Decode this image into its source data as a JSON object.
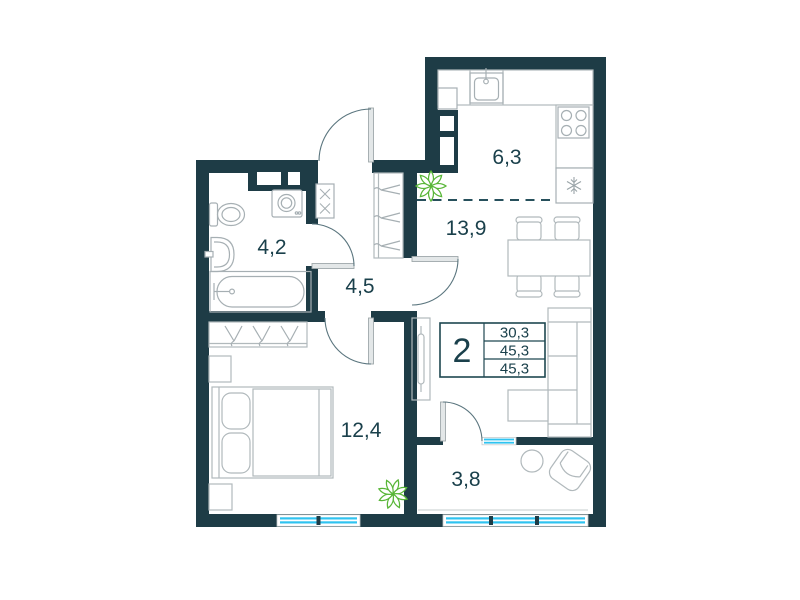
{
  "rooms": {
    "bathroom": {
      "area": "4,2"
    },
    "hallway": {
      "area": "4,5"
    },
    "kitchen": {
      "area": "6,3"
    },
    "living": {
      "area": "13,9"
    },
    "bedroom": {
      "area": "12,4"
    },
    "balcony": {
      "area": "3,8"
    }
  },
  "stats": {
    "rooms_count": "2",
    "areas": [
      "30,3",
      "45,3",
      "45,3"
    ]
  },
  "icons": {
    "plant-icon": "green leaf rosette",
    "stove-icon": "4 burner circles",
    "fridge-icon": "snowflake",
    "kitchen-sink-icon": "basin with faucet",
    "washing-machine-icon": "box with drum circle",
    "toilet-icon": "tank and bowl",
    "bathtub-icon": "rounded tub",
    "wash-basin-icon": "rounded basin",
    "wardrobe-hangers-icon": "clothes hangers",
    "electric-panel-icon": "box with two x marks",
    "ventilation-shaft-icon": "dark block with white inset",
    "door-leaf-icon": "gray bar with quarter-circle swing arc",
    "window-icon": "cyan double line in wall",
    "bed-icon": "bed with two pillows",
    "sofa-icon": "L-shaped sofa",
    "tv-icon": "slim screen on stand",
    "dining-table-icon": "table with four chairs",
    "armchair-icon": "rotated armchair",
    "round-table-icon": "circle table"
  },
  "colors": {
    "wall": "#1e3c46",
    "label_text": "#1a404b",
    "furniture_line": "#b1b9bc",
    "window_glass": "#2fc3f0",
    "plant_green": "#58b637",
    "door_arc": "#5a757e",
    "background": "#ffffff"
  }
}
